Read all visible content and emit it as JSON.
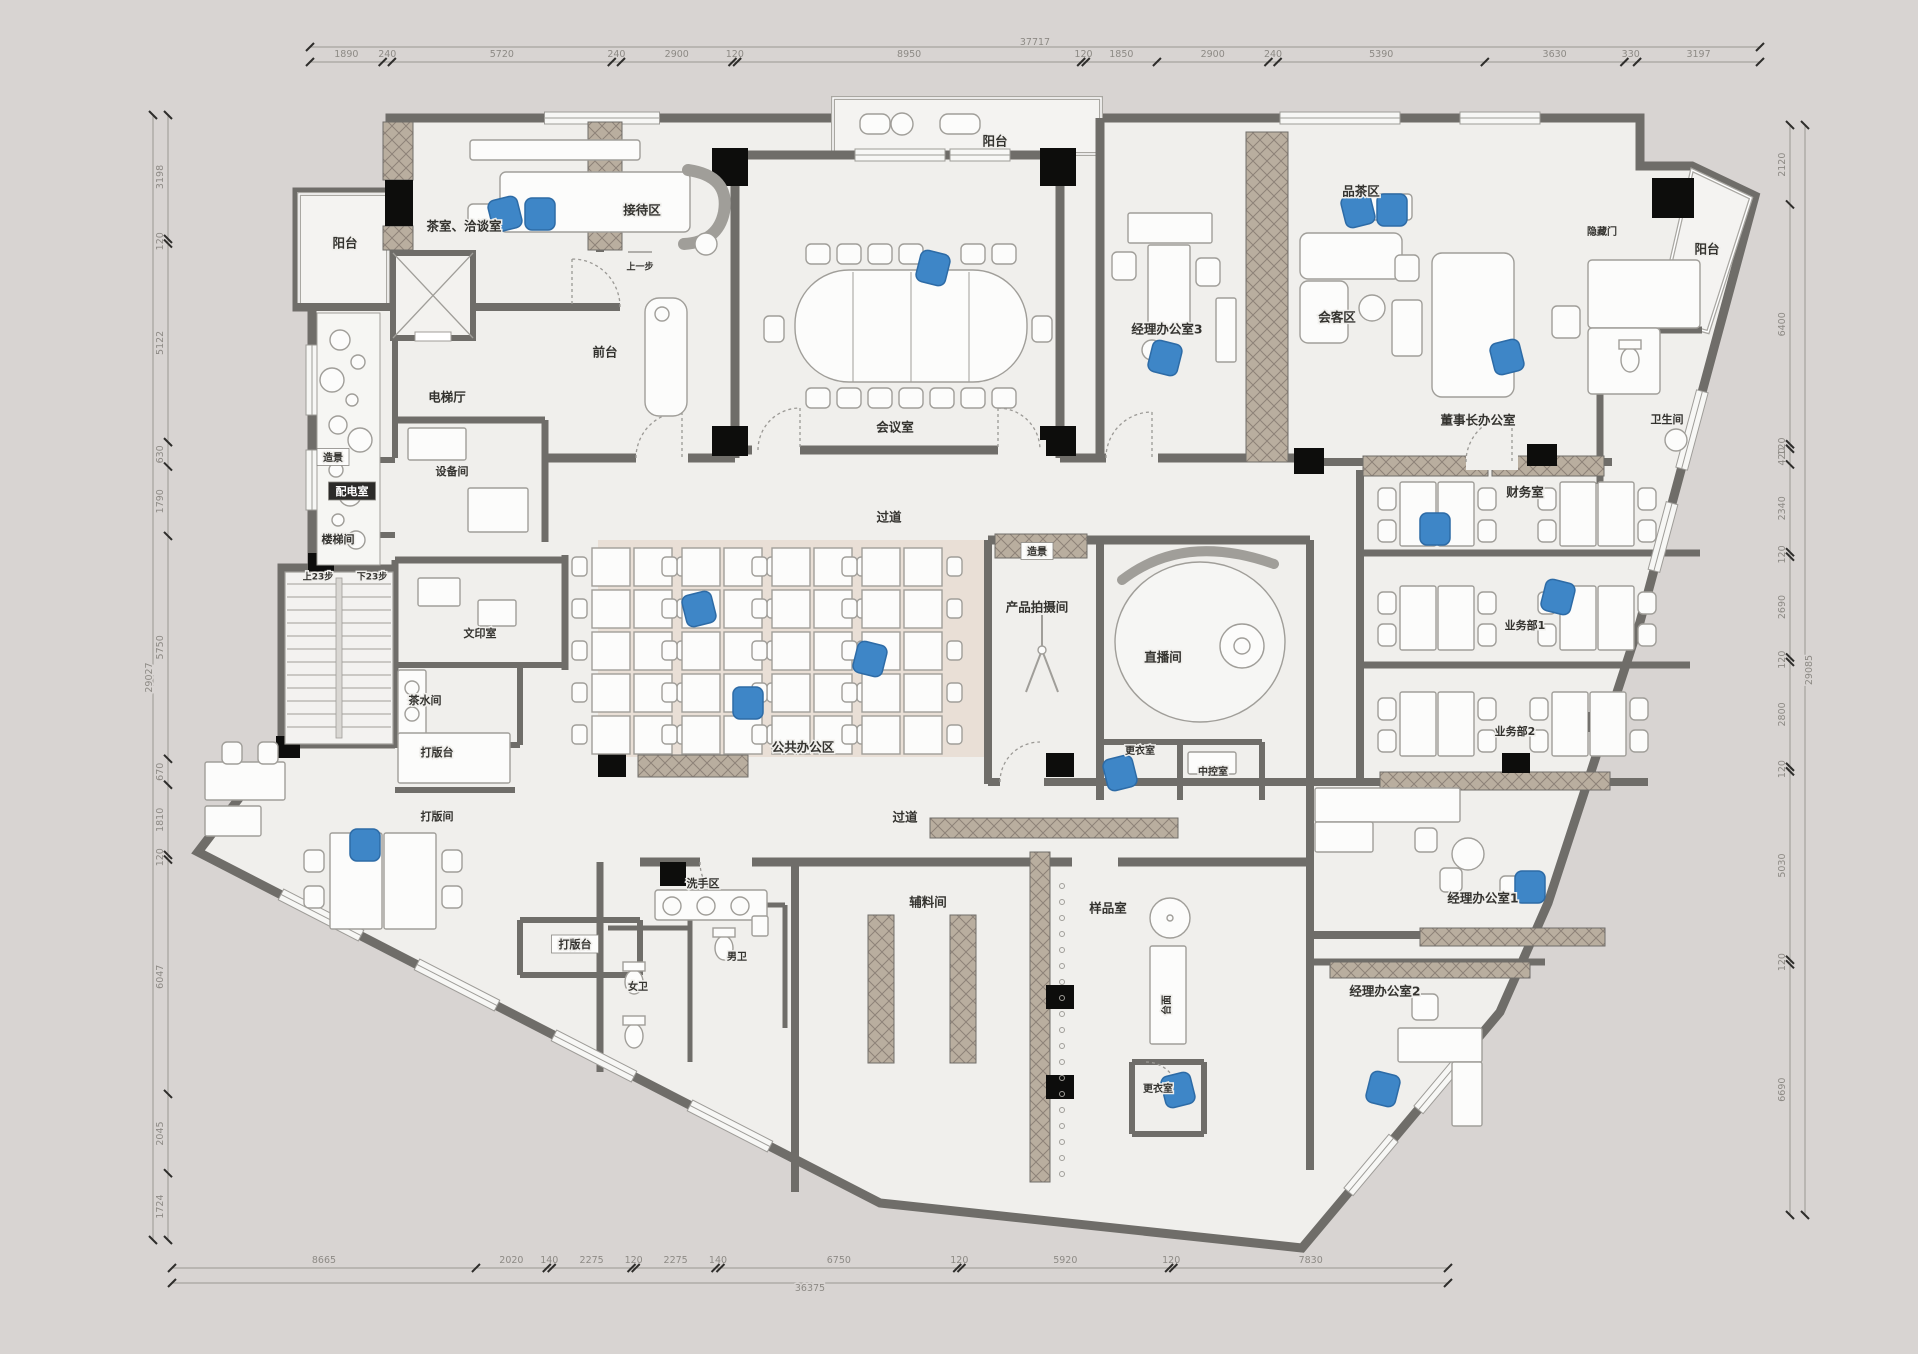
{
  "colors": {
    "background": "#d8d4d2",
    "floor": "#f0efec",
    "wall": "#6f6d69",
    "hatch_base": "#b9ae9f",
    "hatch_line": "#8d8278",
    "column": "#0d0d0c",
    "accent_blue": "#3e86c7",
    "open_office_floor": "#e9dfd6",
    "dim_text": "#8d8a85",
    "label_text": "#34332f",
    "furniture_stroke": "#a09e99",
    "furniture_fill": "#fcfcfb"
  },
  "labels": [
    {
      "id": "balcony-left",
      "text": "阳台"
    },
    {
      "id": "tea-room",
      "text": "茶室、洽谈室"
    },
    {
      "id": "reception",
      "text": "接待区"
    },
    {
      "id": "step-note",
      "text": "上一步"
    },
    {
      "id": "front-desk",
      "text": "前台"
    },
    {
      "id": "elevator-hall",
      "text": "电梯厅"
    },
    {
      "id": "landscape-left",
      "text": "造景"
    },
    {
      "id": "power-room",
      "text": "配电室"
    },
    {
      "id": "stair-room",
      "text": "楼梯间"
    },
    {
      "id": "equipment-room",
      "text": "设备间"
    },
    {
      "id": "stairs-up",
      "text": "上23步"
    },
    {
      "id": "stairs-down",
      "text": "下23步"
    },
    {
      "id": "meeting-room",
      "text": "会议室"
    },
    {
      "id": "balcony-top",
      "text": "阳台"
    },
    {
      "id": "manager-office-3",
      "text": "经理办公室3"
    },
    {
      "id": "tea-area",
      "text": "品茶区"
    },
    {
      "id": "guest-area",
      "text": "会客区"
    },
    {
      "id": "chairman-office",
      "text": "董事长办公室"
    },
    {
      "id": "hidden-door",
      "text": "隐藏门"
    },
    {
      "id": "balcony-right",
      "text": "阳台"
    },
    {
      "id": "restroom-right",
      "text": "卫生间"
    },
    {
      "id": "finance-room",
      "text": "财务室"
    },
    {
      "id": "corridor-upper",
      "text": "过道"
    },
    {
      "id": "landscape-mid",
      "text": "造景"
    },
    {
      "id": "product-photo-room",
      "text": "产品拍摄间"
    },
    {
      "id": "live-room",
      "text": "直播间"
    },
    {
      "id": "public-office",
      "text": "公共办公区"
    },
    {
      "id": "changing-room-mid",
      "text": "更衣室"
    },
    {
      "id": "control-room",
      "text": "中控室"
    },
    {
      "id": "business-dept-1",
      "text": "业务部1"
    },
    {
      "id": "business-dept-2",
      "text": "业务部2"
    },
    {
      "id": "manager-office-1",
      "text": "经理办公室1"
    },
    {
      "id": "manager-office-2",
      "text": "经理办公室2"
    },
    {
      "id": "print-room",
      "text": "文印室"
    },
    {
      "id": "pantry",
      "text": "茶水间"
    },
    {
      "id": "pattern-table-upper",
      "text": "打版台"
    },
    {
      "id": "pattern-room",
      "text": "打版间"
    },
    {
      "id": "pattern-table-lower",
      "text": "打版台"
    },
    {
      "id": "wash-area",
      "text": "洗手区"
    },
    {
      "id": "womens-toilet",
      "text": "女卫"
    },
    {
      "id": "mens-toilet",
      "text": "男卫"
    },
    {
      "id": "corridor-lower",
      "text": "过道"
    },
    {
      "id": "materials-room",
      "text": "辅料间"
    },
    {
      "id": "sample-room",
      "text": "样品室"
    },
    {
      "id": "counter-top",
      "text": "台面"
    },
    {
      "id": "changing-room-bottom",
      "text": "更衣室"
    }
  ],
  "dimensions": {
    "top": {
      "segments": [
        1890,
        240,
        5720,
        240,
        2900,
        120,
        8950,
        120,
        1850,
        2900,
        240,
        5390,
        3630,
        330,
        3197
      ],
      "total": "37717"
    },
    "bottom": {
      "segments": [
        8665,
        2020,
        140,
        2275,
        120,
        2275,
        140,
        6750,
        120,
        5920,
        120,
        7830
      ],
      "total": "36375"
    },
    "left": {
      "segments": [
        3198,
        120,
        5122,
        630,
        1790,
        5750,
        670,
        1810,
        120,
        6047,
        2045,
        1724
      ],
      "total": "29027"
    },
    "right": {
      "segments": [
        2120,
        6400,
        120,
        420,
        2340,
        120,
        2690,
        120,
        2800,
        120,
        5030,
        120,
        6690
      ],
      "total": "29085"
    }
  }
}
